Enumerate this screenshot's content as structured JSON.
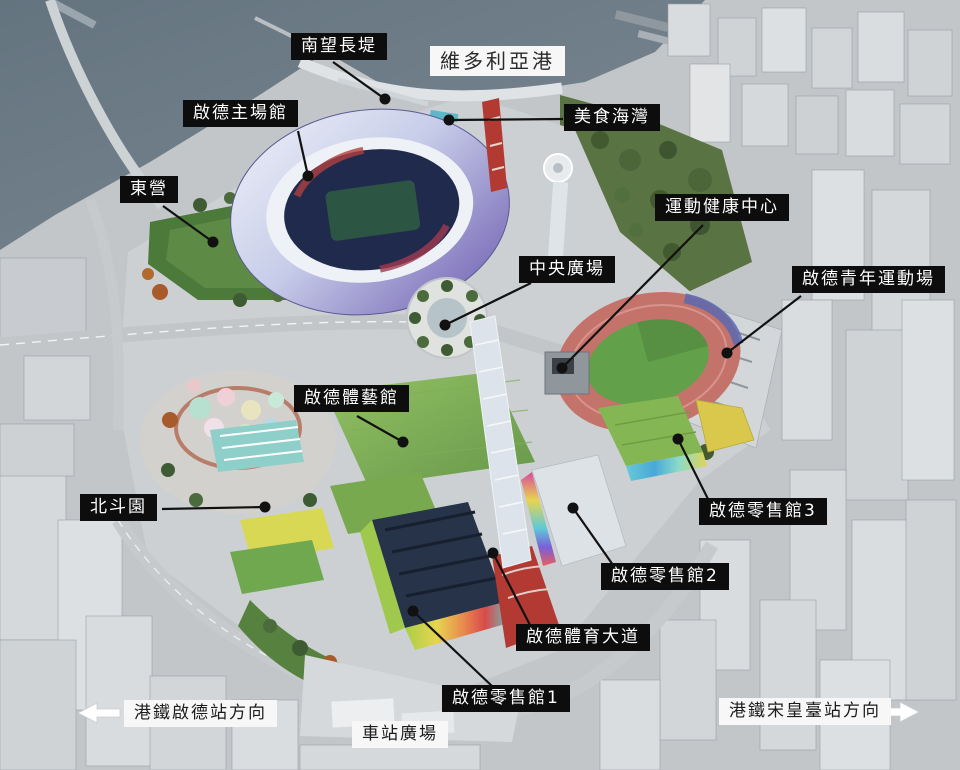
{
  "canvas": {
    "width": 960,
    "height": 770
  },
  "colors": {
    "label_dark_bg": "#0d0d0d",
    "label_dark_text": "#ffffff",
    "label_light_bg": "#f7f7f7",
    "label_light_text": "#1c1c1c",
    "water": "#6e7e8a",
    "city": "#c2c6c9",
    "park_green": "#5d8a45",
    "stadium_shell_purple": "#7e74b8",
    "track_red": "#c4736b",
    "avenue_red": "#b23a32",
    "leader_line": "#111111"
  },
  "labels": {
    "breakwater": "南望長堤",
    "harbour": "維多利亞港",
    "main_stadium": "啟德主場館",
    "dining_cove": "美食海灣",
    "east_lawn": "東營",
    "wellness_centre": "運動健康中心",
    "central_square": "中央廣場",
    "youth_sports_ground": "啟德青年運動場",
    "arena": "啟德體藝館",
    "north_star_park": "北斗園",
    "retail3": "啟德零售館3",
    "retail2": "啟德零售館2",
    "sports_avenue": "啟德體育大道",
    "retail1": "啟德零售館1",
    "station_square": "車站廣場",
    "mtr_kai_tak": "港鐵啟德站方向",
    "mtr_sung_wong_toi": "港鐵宋皇臺站方向"
  },
  "icons": {
    "mtr_left_arrow": "arrow-left",
    "mtr_right_arrow": "arrow-right"
  }
}
